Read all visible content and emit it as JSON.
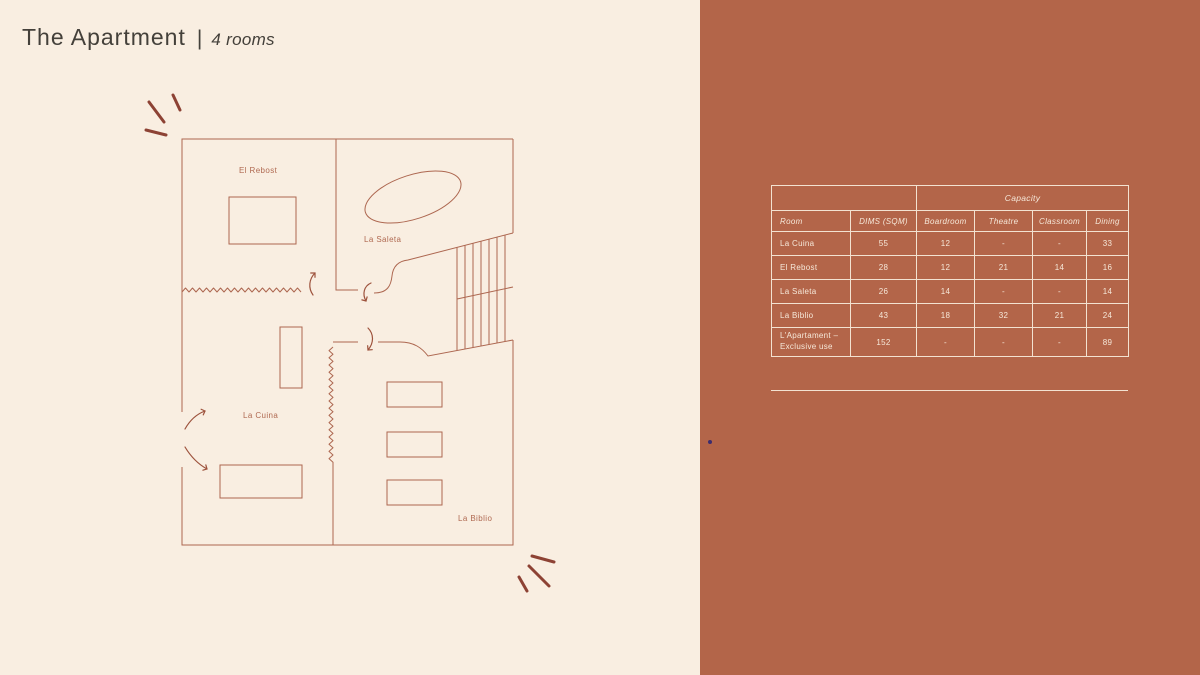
{
  "slide": {
    "title": "The Apartment",
    "divider": "|",
    "subtitle": "4 rooms"
  },
  "floorplan": {
    "rooms": [
      {
        "label": "El Rebost"
      },
      {
        "label": "La Saleta"
      },
      {
        "label": "La Cuina"
      },
      {
        "label": "La Biblio"
      }
    ]
  },
  "table": {
    "capacity_header": "Capacity",
    "columns": [
      "Room",
      "DIMS (SQM)",
      "Boardroom",
      "Theatre",
      "Classroom",
      "Dining"
    ],
    "rows": [
      {
        "cells": [
          "La Cuina",
          "55",
          "12",
          "-",
          "-",
          "33"
        ]
      },
      {
        "cells": [
          "El Rebost",
          "28",
          "12",
          "21",
          "14",
          "16"
        ]
      },
      {
        "cells": [
          "La Saleta",
          "26",
          "14",
          "-",
          "-",
          "14"
        ]
      },
      {
        "cells": [
          "La Biblio",
          "43",
          "18",
          "32",
          "21",
          "24"
        ]
      },
      {
        "cells": [
          "L'Apartament –\nExclusive use",
          "152",
          "-",
          "-",
          "-",
          "89"
        ]
      }
    ]
  },
  "colors": {
    "left_background": "#f9eee1",
    "right_background": "#b36549",
    "plan_line": "#ad6750",
    "plan_accent": "#8d4234",
    "table_line": "#f3e2d1",
    "table_text": "#f6e8d9",
    "title_text": "#44403a"
  }
}
